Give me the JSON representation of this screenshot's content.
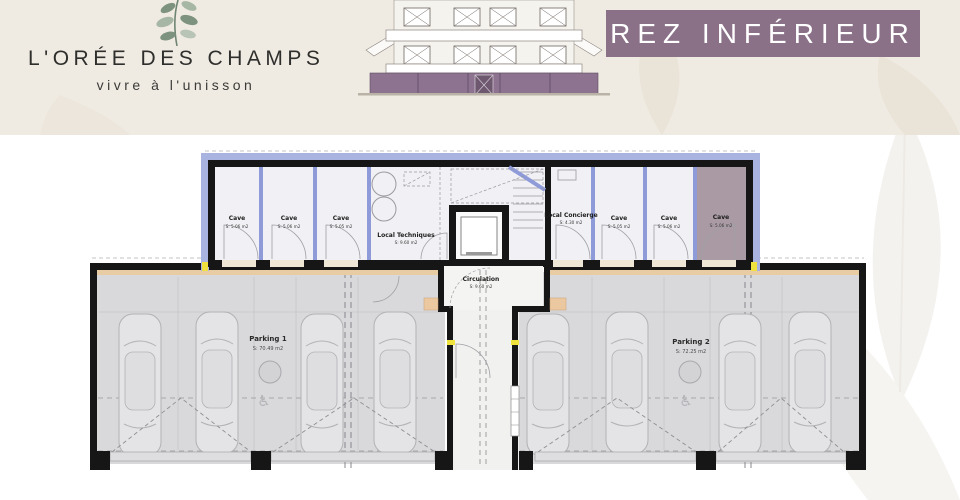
{
  "header": {
    "logo": {
      "title": "L'ORÉE DES CHAMPS",
      "subtitle": "vivre à l'unisson"
    },
    "banner": {
      "label": "REZ INFÉRIEUR"
    }
  },
  "plan": {
    "rooms": [
      {
        "name": "Cave",
        "area": "S: 5.06 m2"
      },
      {
        "name": "Cave",
        "area": "S: 5.06 m2"
      },
      {
        "name": "Cave",
        "area": "S: 5.05 m2"
      },
      {
        "name": "Local Techniques",
        "area": "S: 9.60 m2"
      },
      {
        "name": "Circulation",
        "area": "S: 9.60 m2"
      },
      {
        "name": "Local Concierge",
        "area": "S: 4.30 m2"
      },
      {
        "name": "Cave",
        "area": "S: 5.05 m2"
      },
      {
        "name": "Cave",
        "area": "S: 5.06 m2"
      },
      {
        "name": "Cave",
        "area": "S: 5.06 m2",
        "highlighted": true
      },
      {
        "name": "Parking 1",
        "area": "S: 70.49 m2"
      },
      {
        "name": "Parking 2",
        "area": "S: 72.25 m2"
      }
    ],
    "icons": {
      "accessible": "♿"
    },
    "colors": {
      "banner_purple": "#8a7188",
      "highlight_mauve": "#a99aa4",
      "insulation_blue": "#a9b3e0",
      "wall_black": "#161616",
      "wood_tan": "#e8cda4",
      "parking_gray": "#d9d9db",
      "header_beige": "#f0ebe2"
    }
  }
}
